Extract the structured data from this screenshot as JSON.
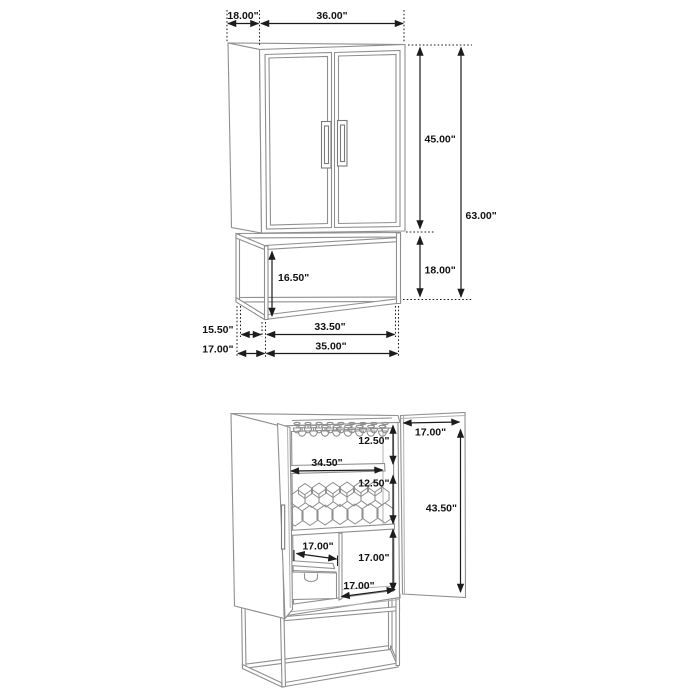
{
  "meta": {
    "description": "Dimension diagram of a 2-door bar cabinet with stemware rack, wine rack, drawer and open metal base",
    "unit": "inches"
  },
  "colors": {
    "background": "#ffffff",
    "furniture_line": "#8f8f8f",
    "dimension_line": "#1c1c1c",
    "label_text": "#111111"
  },
  "closed_view": {
    "name": "front view doors closed",
    "dims": {
      "top_depth": "18.00\"",
      "top_width": "36.00\"",
      "upper_cabinet_height": "45.00\"",
      "overall_height": "63.00\"",
      "base_height": "18.00\"",
      "base_opening_height": "16.50\"",
      "base_inner_depth": "15.50\"",
      "base_depth": "17.00\"",
      "base_inner_width": "33.50\"",
      "base_width": "35.00\""
    }
  },
  "open_view": {
    "name": "front view doors open",
    "dims": {
      "stemware_section_height": "12.50\"",
      "interior_width": "34.50\"",
      "wine_rack_section_height": "12.50\"",
      "door_width": "17.00\"",
      "door_height": "43.50\"",
      "drawer_depth": "17.00\"",
      "lower_section_height": "17.00\"",
      "bottom_shelf_depth": "17.00\""
    }
  }
}
